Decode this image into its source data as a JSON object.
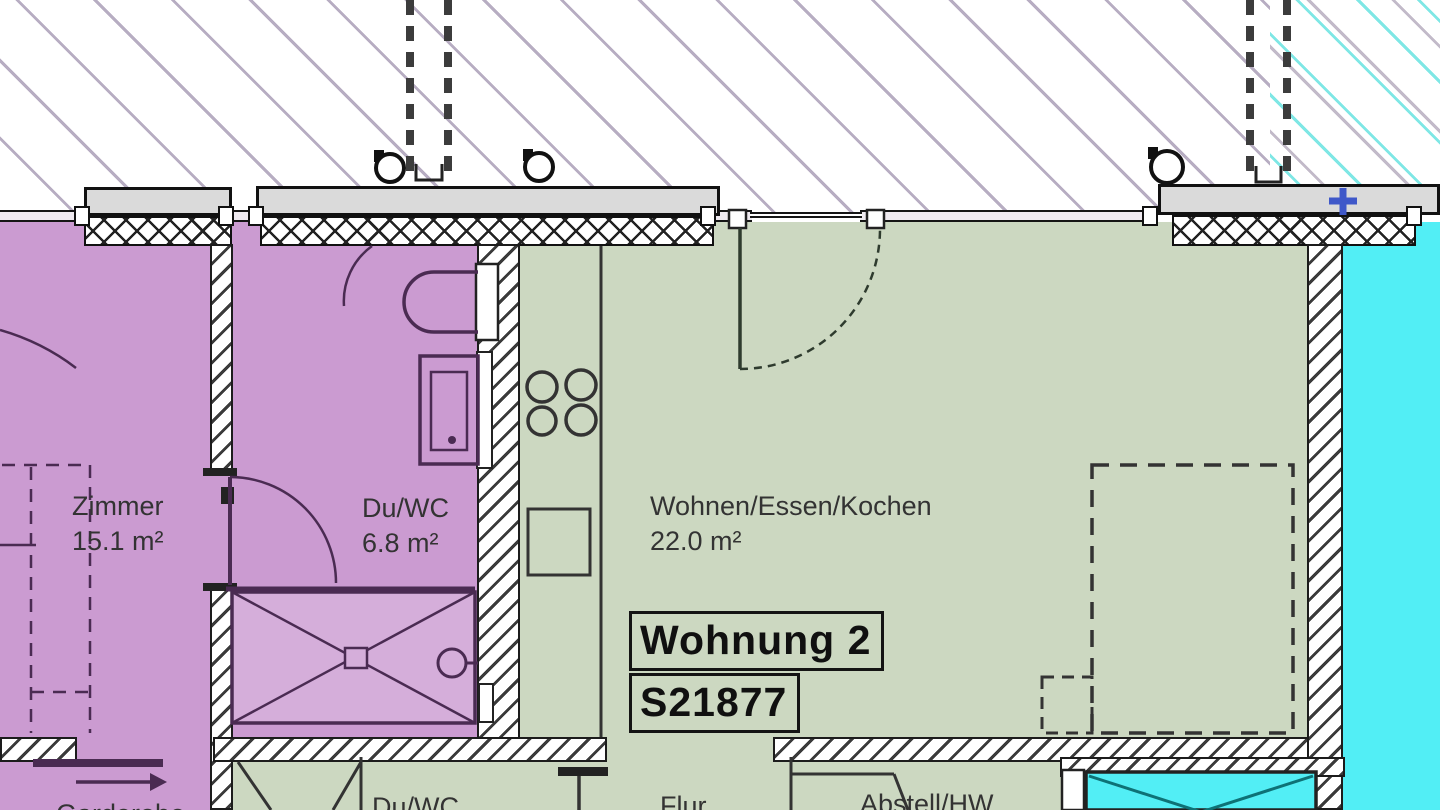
{
  "plan": {
    "apartment": {
      "name": "Wohnung 2",
      "code": "S21877"
    },
    "rooms": {
      "zimmer": {
        "name": "Zimmer",
        "area": "15.1 m²"
      },
      "duwc": {
        "name": "Du/WC",
        "area": "6.8 m²"
      },
      "wohnen": {
        "name": "Wohnen/Essen/Kochen",
        "area": "22.0 m²"
      },
      "flur": {
        "name": "Flur"
      },
      "duwc_2": {
        "name": "Du/WC"
      },
      "abstell": {
        "name": "Abstell/HW"
      },
      "garderobe": {
        "name": "Garderobe"
      }
    },
    "colors": {
      "unit_left_fill": "#cb9bd1",
      "unit_center_fill": "#ccd8c1",
      "unit_right_fill": "#52eef5",
      "shower_fill": "#d5aeda",
      "sill_gray": "#dadada",
      "marker_blue_cross": "#3f58c9",
      "hatch_left": "#b7adc2",
      "hatch_right_cyan": "#7fe7e5",
      "line_purple": "#4a2b52",
      "line_dark": "#1c1c1c"
    }
  }
}
